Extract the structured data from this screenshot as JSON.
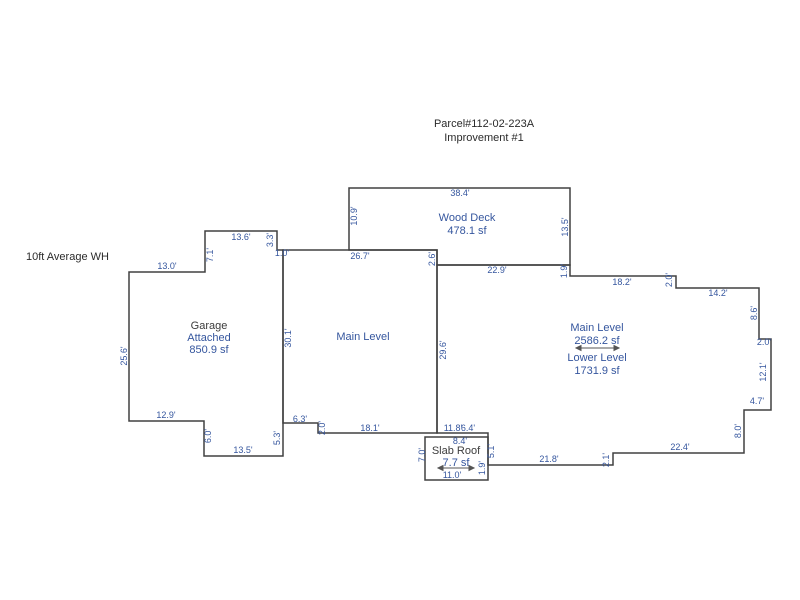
{
  "header": {
    "line1": "Parcel#112-02-223A",
    "line2": "Improvement #1"
  },
  "note": "10ft Average WH",
  "colors": {
    "outline": "#404040",
    "blue": "#35569E",
    "dark": "#3C3C3C",
    "title": "#2B2B2B",
    "arrow": "#555555",
    "background": "#FFFFFF"
  },
  "areas": {
    "garage": {
      "name": "Garage",
      "type": "Attached",
      "area": "850.9 sf"
    },
    "main_center": {
      "name": "Main Level"
    },
    "wood_deck": {
      "name": "Wood Deck",
      "area": "478.1 sf"
    },
    "main_right": {
      "name": "Main Level",
      "area": "2586.2 sf",
      "name2": "Lower Level",
      "area2": "1731.9 sf"
    },
    "slab_roof": {
      "name": "Slab Roof",
      "area": "7.7 sf"
    }
  },
  "dimensions": {
    "g_top": "13.6'",
    "g_71": "7.1'",
    "g_33": "3.3'",
    "g_10": "1.0'",
    "g_130": "13.0'",
    "g_256": "25.6'",
    "g_129": "12.9'",
    "g_60": "6.0'",
    "g_135": "13.5'",
    "g_53": "5.3'",
    "mc_top": "26.7'",
    "mc_left": "30.1'",
    "mc_26": "2.6'",
    "mc_right": "29.6'",
    "mc_63": "6.3'",
    "mc_20": "2.0'",
    "mc_bot": "18.1'",
    "d_top": "38.4'",
    "d_left": "10.9'",
    "d_right": "13.5'",
    "d_bot": "22.9'",
    "d_19": "1.9'",
    "r_182": "18.2'",
    "r_20a": "2.0'",
    "r_142": "14.2'",
    "r_86": "8.6'",
    "r_20b": "2.0'",
    "r_121": "12.1'",
    "r_47": "4.7'",
    "r_80": "8.0'",
    "r_224": "22.4'",
    "r_21": "2.1'",
    "r_218": "21.8'",
    "s_118": "11.8'",
    "s_64": "6.4'",
    "s_84": "8.4'",
    "s_70": "7.0'",
    "s_51": "5.1'",
    "s_110": "11.0'",
    "s_19": "1.9'"
  }
}
